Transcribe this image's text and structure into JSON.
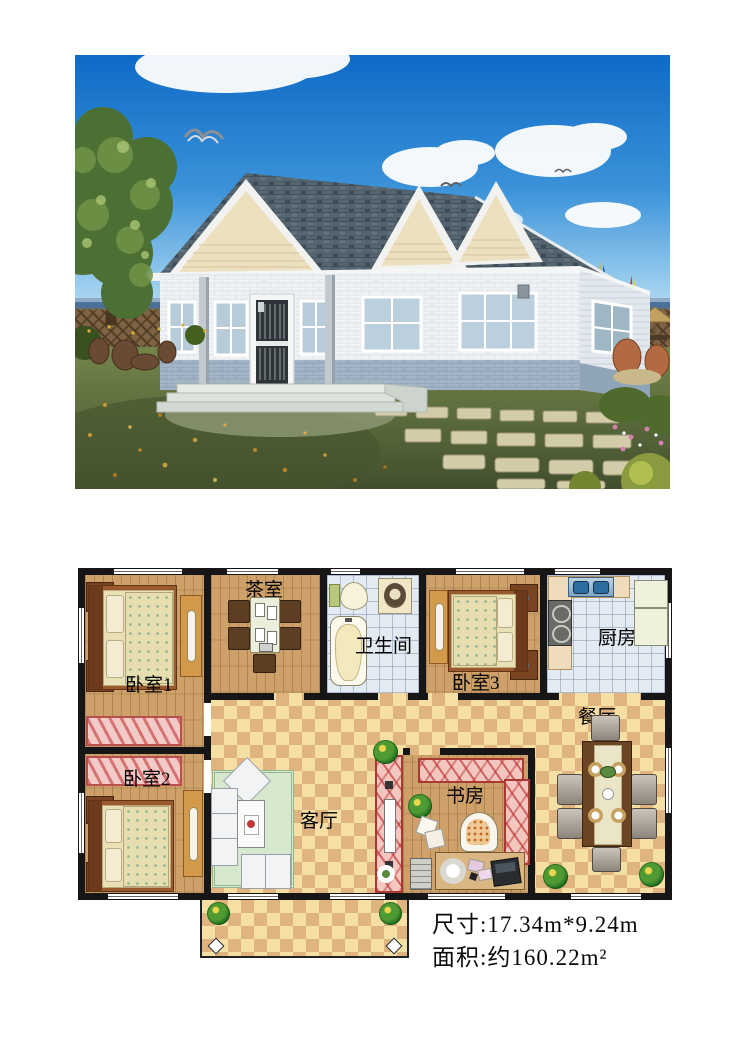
{
  "photo": {
    "description": "exterior-render-of-single-storey-house",
    "colors": {
      "sky_top": "#0e6ac6",
      "sky_horizon": "#d9eef8",
      "roof": "#55656f",
      "gable": "#ece0bf",
      "wall_brick": "#eff2f5",
      "wainscot": "#a3b5c6",
      "grass": "#5b6b3c",
      "sea": "#3c6d9d"
    }
  },
  "floor_plan": {
    "rooms": [
      {
        "id": "bedroom1",
        "label": "卧室1"
      },
      {
        "id": "tearoom",
        "label": "茶室"
      },
      {
        "id": "bathroom",
        "label": "卫生间"
      },
      {
        "id": "bedroom3",
        "label": "卧室3"
      },
      {
        "id": "kitchen",
        "label": "厨房"
      },
      {
        "id": "bedroom2",
        "label": "卧室2"
      },
      {
        "id": "living",
        "label": "客厅"
      },
      {
        "id": "study",
        "label": "书房"
      },
      {
        "id": "dining",
        "label": "餐厅"
      }
    ],
    "dimensions_line": "尺寸:17.34m*9.24m",
    "area_line": "面积:约160.22m²",
    "colors": {
      "wall": "#161616",
      "wood_floor": "#cda169",
      "tile_floor": "#e3eaf1",
      "checker_light": "#f5dfa5",
      "checker_dark": "#dfb47e",
      "rug": "#f2cbc9"
    }
  }
}
